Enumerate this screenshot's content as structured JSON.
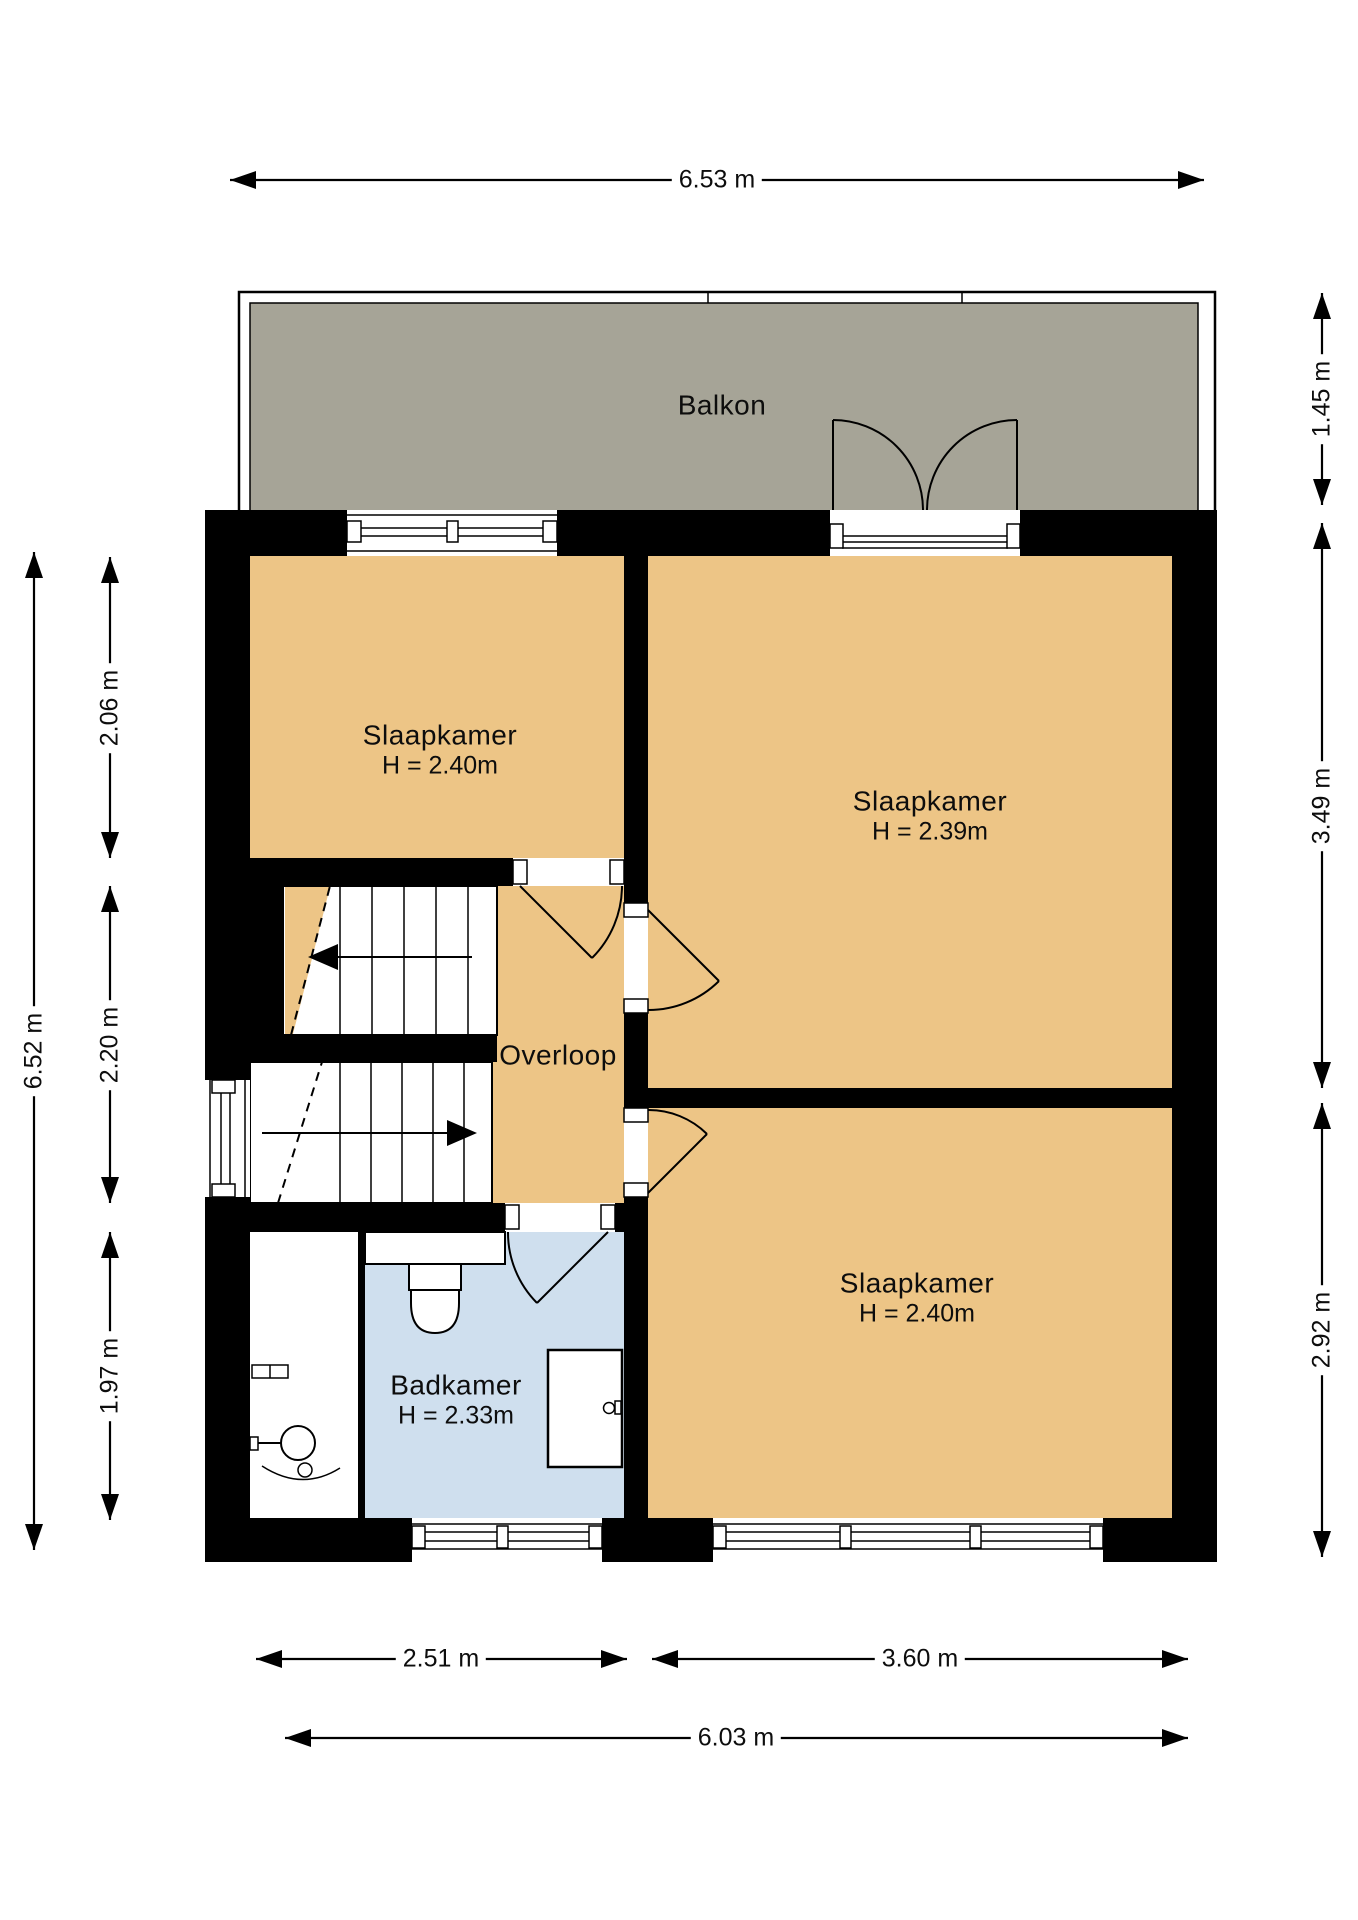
{
  "plan": {
    "rooms": [
      {
        "id": "balkon",
        "label": "Balkon"
      },
      {
        "id": "slaapkamer-1",
        "label": "Slaapkamer",
        "height": "H = 2.40m"
      },
      {
        "id": "slaapkamer-2",
        "label": "Slaapkamer",
        "height": "H = 2.39m"
      },
      {
        "id": "slaapkamer-3",
        "label": "Slaapkamer",
        "height": "H = 2.40m"
      },
      {
        "id": "overloop",
        "label": "Overloop"
      },
      {
        "id": "badkamer",
        "label": "Badkamer",
        "height": "H = 2.33m"
      }
    ],
    "dimensions": {
      "top_width": "6.53 m",
      "balcony_depth": "1.45 m",
      "bedroom2_depth": "3.49 m",
      "bedroom3_depth": "2.92 m",
      "left_total": "6.52 m",
      "bedroom1_depth": "2.06 m",
      "landing_depth": "2.20 m",
      "bathroom_depth": "1.97 m",
      "bottom_left_width": "2.51 m",
      "bottom_right_width": "3.60 m",
      "bottom_total": "6.03 m"
    },
    "colors": {
      "floor": "#edc586",
      "balcony": "#a6a497",
      "bathroom": "#cfdfee",
      "wall": "#000000"
    }
  }
}
